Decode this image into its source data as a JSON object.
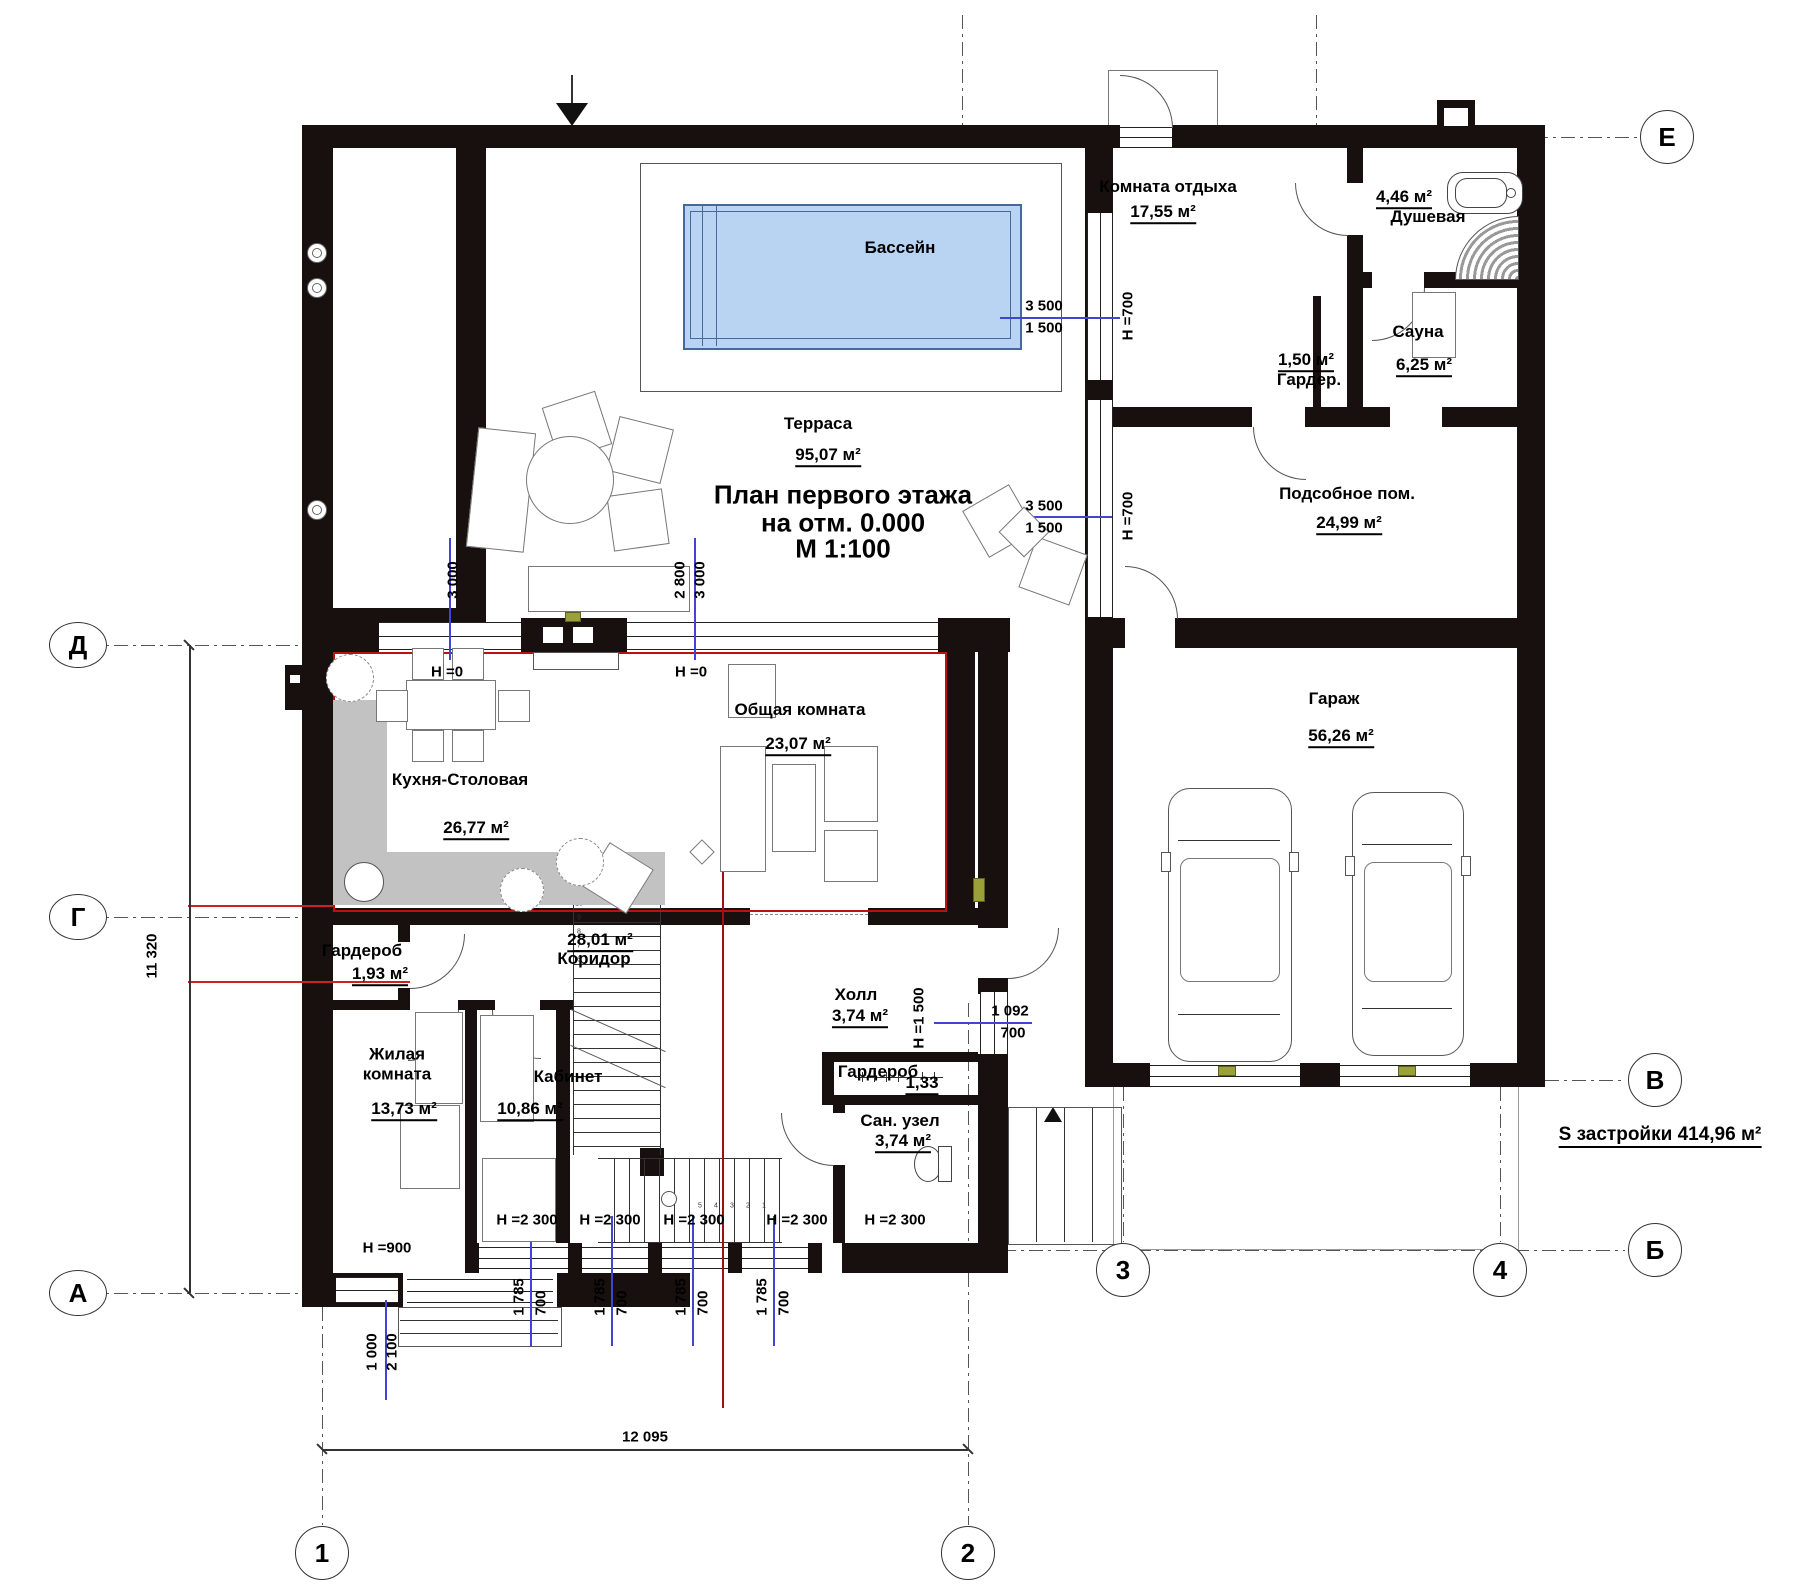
{
  "title": {
    "line1": "План первого этажа",
    "line2": "на отм. 0.000",
    "line3": "М 1:100"
  },
  "rooms": {
    "pool": {
      "name": "Бассейн"
    },
    "terrace": {
      "name": "Терраса",
      "area": "95,07 м²"
    },
    "lounge": {
      "name": "Комната отдыха",
      "area": "17,55 м²"
    },
    "shower": {
      "name": "Душевая",
      "area": "4,46 м²"
    },
    "sauna": {
      "name": "Сауна",
      "area": "6,25 м²"
    },
    "closet_top": {
      "name": "Гардер.",
      "area": "1,50 м²"
    },
    "utility": {
      "name": "Подсобное пом.",
      "area": "24,99 м²"
    },
    "garage": {
      "name": "Гараж",
      "area": "56,26 м²"
    },
    "kitchen": {
      "name": "Кухня-Столовая",
      "area": "26,77 м²"
    },
    "living": {
      "name": "Общая комната",
      "area": "23,07 м²"
    },
    "corridor": {
      "name": "Коридор",
      "area": "28,01 м²"
    },
    "wardrobe1": {
      "name": "Гардероб",
      "area": "1,93 м²"
    },
    "bedroom": {
      "name": "Жилая комната",
      "area": "13,73 м²"
    },
    "study": {
      "name": "Кабинет",
      "area": "10,86 м²"
    },
    "hall": {
      "name": "Холл",
      "area": "3,74 м²"
    },
    "wardrobe2": {
      "name": "Гардероб",
      "area": "1,33"
    },
    "wc": {
      "name": "Сан. узел",
      "area": "3,74 м²"
    }
  },
  "summary": "S застройки 414,96 м²",
  "dims": {
    "d3500": "3 500",
    "d1500": "1 500",
    "d3000": "3 000",
    "d2800": "2 800",
    "d1092": "1 092",
    "d700": "700",
    "d1785": "1 785",
    "d1000": "1 000",
    "d2100": "2 100",
    "d12095": "12 095",
    "d11320": "11 320",
    "h0": "Н =0",
    "h700": "Н =700",
    "h1500": "Н =1 500",
    "h2300": "Н =2 300",
    "h900": "Н =900"
  },
  "axes": {
    "E": "Е",
    "D": "Д",
    "G": "Г",
    "V": "В",
    "B": "Б",
    "A": "А",
    "n1": "1",
    "n2": "2",
    "n3": "3",
    "n4": "4"
  },
  "stairs": {
    "upper_steps": "6 7 8 9 10 11",
    "lower_steps": "5 4 3 2 1"
  },
  "colors": {
    "wall": "#17100f",
    "pool_fill": "#b8d4f2",
    "pool_border": "#46689a",
    "dim_blue": "#4343d6",
    "accent_red": "#c22222",
    "counter_gray": "#c2c2c2"
  }
}
